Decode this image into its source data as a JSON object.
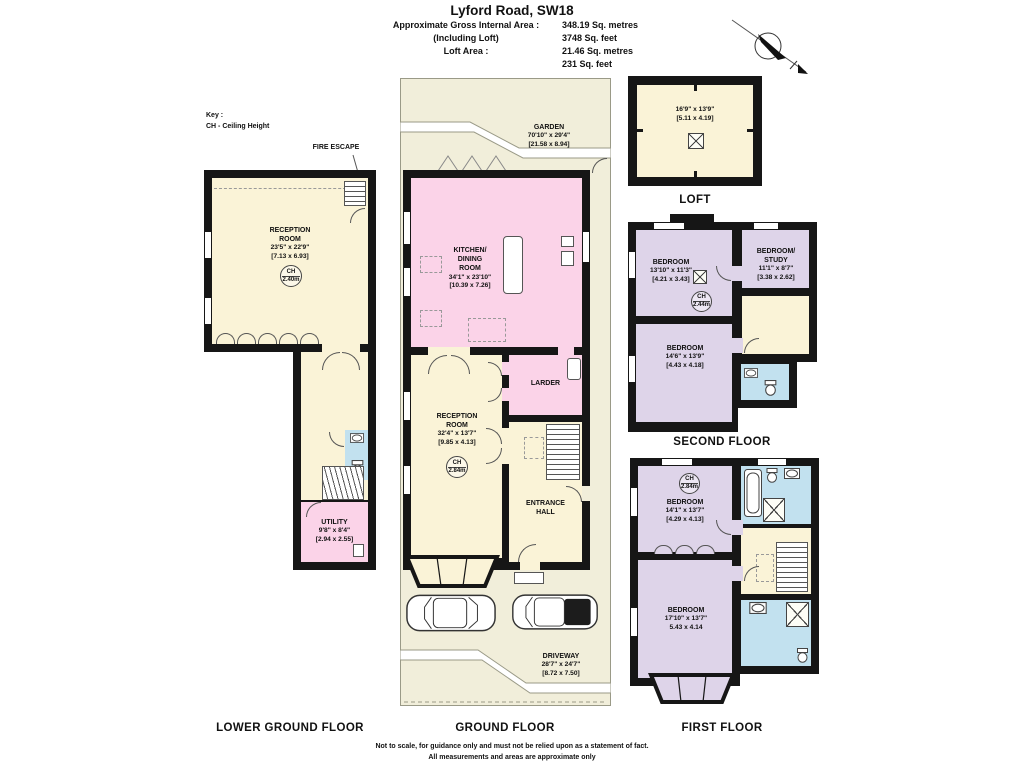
{
  "colors": {
    "wall": "#161616",
    "cream": "#faf3d7",
    "pink": "#fbd3e8",
    "lavender": "#ded4e9",
    "blue": "#c2e1ef",
    "outdoor": "#f1eeda"
  },
  "header": {
    "title": "Lyford Road, SW18",
    "rows": [
      {
        "label": "Approximate Gross Internal Area :",
        "value": "348.19 Sq. metres"
      },
      {
        "label": "(Including Loft)",
        "value": "3748 Sq. feet"
      },
      {
        "label": "Loft Area :",
        "value": "21.46 Sq. metres"
      },
      {
        "label": "",
        "value": "231 Sq. feet"
      }
    ]
  },
  "key": {
    "title": "Key :",
    "entry": "CH - Ceiling Height"
  },
  "annotations": {
    "fire_escape": "FIRE ESCAPE"
  },
  "icons": {
    "north_arrow": "north-arrow",
    "car": "car-top-view",
    "bath": "bathtub",
    "toilet": "toilet",
    "basin": "basin",
    "shower": "shower-tray",
    "loft_hatch": "crossed-box",
    "stairs": "staircase"
  },
  "floors": {
    "lower_ground": {
      "title": "LOWER GROUND FLOOR",
      "reception": {
        "line1": "RECEPTION",
        "line2": "ROOM",
        "imperial": "23'5\" x 22'9\"",
        "metric": "[7.13 x 6.93]",
        "ch_label": "CH",
        "ch_value": "2.40m"
      },
      "utility": {
        "line1": "UTILITY",
        "imperial": "9'8\" x 8'4\"",
        "metric": "[2.94 x 2.55]"
      }
    },
    "ground": {
      "title": "GROUND FLOOR",
      "garden": {
        "line1": "GARDEN",
        "imperial": "70'10\" x 29'4\"",
        "metric": "[21.58 x 8.94]"
      },
      "kitchen": {
        "line1": "KITCHEN/",
        "line2": "DINING",
        "line3": "ROOM",
        "imperial": "34'1\" x 23'10\"",
        "metric": "[10.39 x 7.26]"
      },
      "larder": {
        "line1": "LARDER"
      },
      "reception": {
        "line1": "RECEPTION",
        "line2": "ROOM",
        "imperial": "32'4\" x 13'7\"",
        "metric": "[9.85 x 4.13]",
        "ch_label": "CH",
        "ch_value": "2.84m"
      },
      "entrance": {
        "line1": "ENTRANCE",
        "line2": "HALL"
      },
      "driveway": {
        "line1": "DRIVEWAY",
        "imperial": "28'7\" x 24'7\"",
        "metric": "[8.72 x 7.50]"
      }
    },
    "loft": {
      "title": "LOFT",
      "room": {
        "imperial": "16'9\" x 13'9\"",
        "metric": "[5.11 x 4.19]"
      }
    },
    "second": {
      "title": "SECOND FLOOR",
      "bedroom1": {
        "line1": "BEDROOM",
        "imperial": "13'10\" x 11'3\"",
        "metric": "[4.21 x 3.43]",
        "ch_label": "CH",
        "ch_value": "2.44m"
      },
      "bedroom_study": {
        "line1": "BEDROOM/",
        "line2": "STUDY",
        "imperial": "11'1\" x 8'7\"",
        "metric": "[3.38 x 2.62]"
      },
      "bedroom2": {
        "line1": "BEDROOM",
        "imperial": "14'6\" x 13'9\"",
        "metric": "[4.43 x 4.18]"
      }
    },
    "first": {
      "title": "FIRST FLOOR",
      "bedroom1": {
        "line1": "BEDROOM",
        "imperial": "14'1\" x 13'7\"",
        "metric": "[4.29 x 4.13]",
        "ch_label": "CH",
        "ch_value": "2.84m"
      },
      "bedroom2": {
        "line1": "BEDROOM",
        "imperial": "17'10\" x 13'7\"",
        "metric": "5.43 x 4.14"
      }
    }
  },
  "footer": {
    "line1": "Not to scale, for guidance only and must not be relied upon as a statement of fact.",
    "line2": "All measurements and areas are approximate only"
  }
}
